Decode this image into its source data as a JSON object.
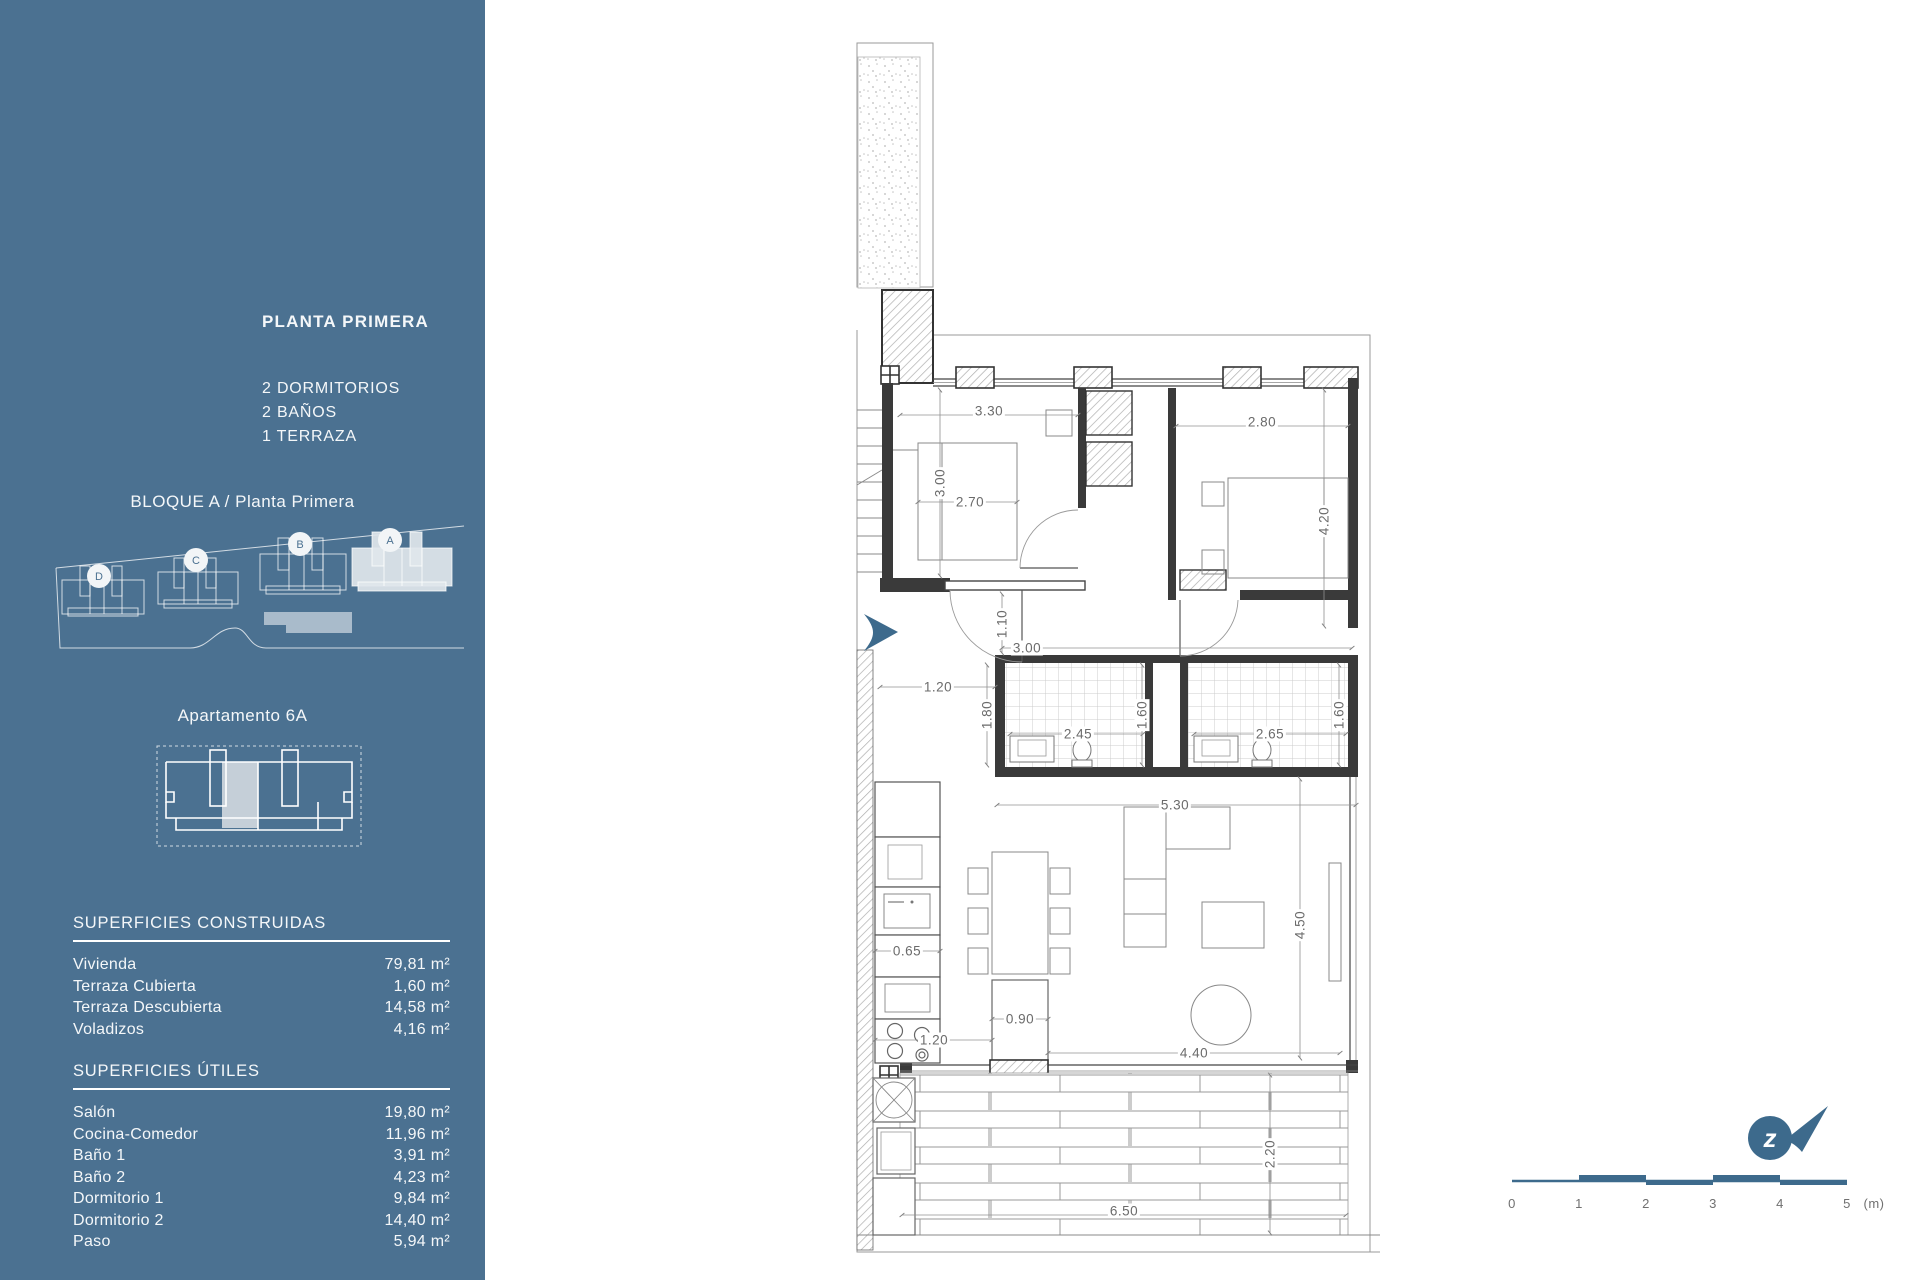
{
  "colors": {
    "sidebar_bg": "#4B7191",
    "accent": "#3D6A8C",
    "plan_line": "#3a3a3a",
    "dim_text": "#6b6b6b"
  },
  "sidebar": {
    "title": "PLANTA PRIMERA",
    "features": [
      "2 DORMITORIOS",
      "2 BAÑOS",
      "1 TERRAZA"
    ],
    "block_label": "BLOQUE A / Planta Primera",
    "site_buildings": [
      "D",
      "C",
      "B",
      "A"
    ],
    "apartment_label": "Apartamento 6A",
    "surfaces_built": {
      "heading": "SUPERFICIES CONSTRUIDAS",
      "rows": [
        {
          "label": "Vivienda",
          "value": "79,81 m²"
        },
        {
          "label": "Terraza Cubierta",
          "value": "1,60 m²"
        },
        {
          "label": "Terraza Descubierta",
          "value": "14,58 m²"
        },
        {
          "label": "Voladizos",
          "value": "4,16 m²"
        }
      ]
    },
    "surfaces_useful": {
      "heading": "SUPERFICIES ÚTILES",
      "rows": [
        {
          "label": "Salón",
          "value": "19,80 m²"
        },
        {
          "label": "Cocina-Comedor",
          "value": "11,96 m²"
        },
        {
          "label": "Baño 1",
          "value": "3,91 m²"
        },
        {
          "label": "Baño 2",
          "value": "4,23 m²"
        },
        {
          "label": "Dormitorio 1",
          "value": "9,84 m²"
        },
        {
          "label": "Dormitorio 2",
          "value": "14,40 m²"
        },
        {
          "label": "Paso",
          "value": "5,94 m²"
        }
      ]
    }
  },
  "plan": {
    "dimensions": [
      {
        "t": "3.30",
        "x": 139,
        "y": 381,
        "r": 0
      },
      {
        "t": "2.80",
        "x": 412,
        "y": 392,
        "r": 0
      },
      {
        "t": "3.00",
        "x": 90,
        "y": 453,
        "r": -90
      },
      {
        "t": "2.70",
        "x": 120,
        "y": 472,
        "r": 0
      },
      {
        "t": "4.20",
        "x": 474,
        "y": 491,
        "r": -90
      },
      {
        "t": "1.10",
        "x": 152,
        "y": 594,
        "r": -90
      },
      {
        "t": "3.00",
        "x": 177,
        "y": 618,
        "r": 0
      },
      {
        "t": "1.20",
        "x": 88,
        "y": 657,
        "r": 0
      },
      {
        "t": "1.80",
        "x": 137,
        "y": 685,
        "r": -90
      },
      {
        "t": "2.45",
        "x": 228,
        "y": 704,
        "r": 0
      },
      {
        "t": "1.60",
        "x": 292,
        "y": 685,
        "r": -90
      },
      {
        "t": "2.65",
        "x": 420,
        "y": 704,
        "r": 0
      },
      {
        "t": "1.60",
        "x": 489,
        "y": 685,
        "r": -90
      },
      {
        "t": "5.30",
        "x": 325,
        "y": 775,
        "r": 0
      },
      {
        "t": "0.65",
        "x": 57,
        "y": 921,
        "r": 0
      },
      {
        "t": "0.90",
        "x": 170,
        "y": 989,
        "r": 0
      },
      {
        "t": "1.20",
        "x": 84,
        "y": 1010,
        "r": 0
      },
      {
        "t": "4.50",
        "x": 450,
        "y": 895,
        "r": -90
      },
      {
        "t": "4.40",
        "x": 344,
        "y": 1023,
        "r": 0
      },
      {
        "t": "2.20",
        "x": 420,
        "y": 1124,
        "r": -90
      },
      {
        "t": "6.50",
        "x": 274,
        "y": 1181,
        "r": 0
      }
    ]
  },
  "footer": {
    "north_glyph": "z",
    "scale_labels": [
      {
        "text": "0",
        "x": 14
      },
      {
        "text": "1",
        "x": 81
      },
      {
        "text": "2",
        "x": 148
      },
      {
        "text": "3",
        "x": 215
      },
      {
        "text": "4",
        "x": 282
      },
      {
        "text": "5",
        "x": 349
      },
      {
        "text": "(m)",
        "x": 376
      }
    ]
  }
}
